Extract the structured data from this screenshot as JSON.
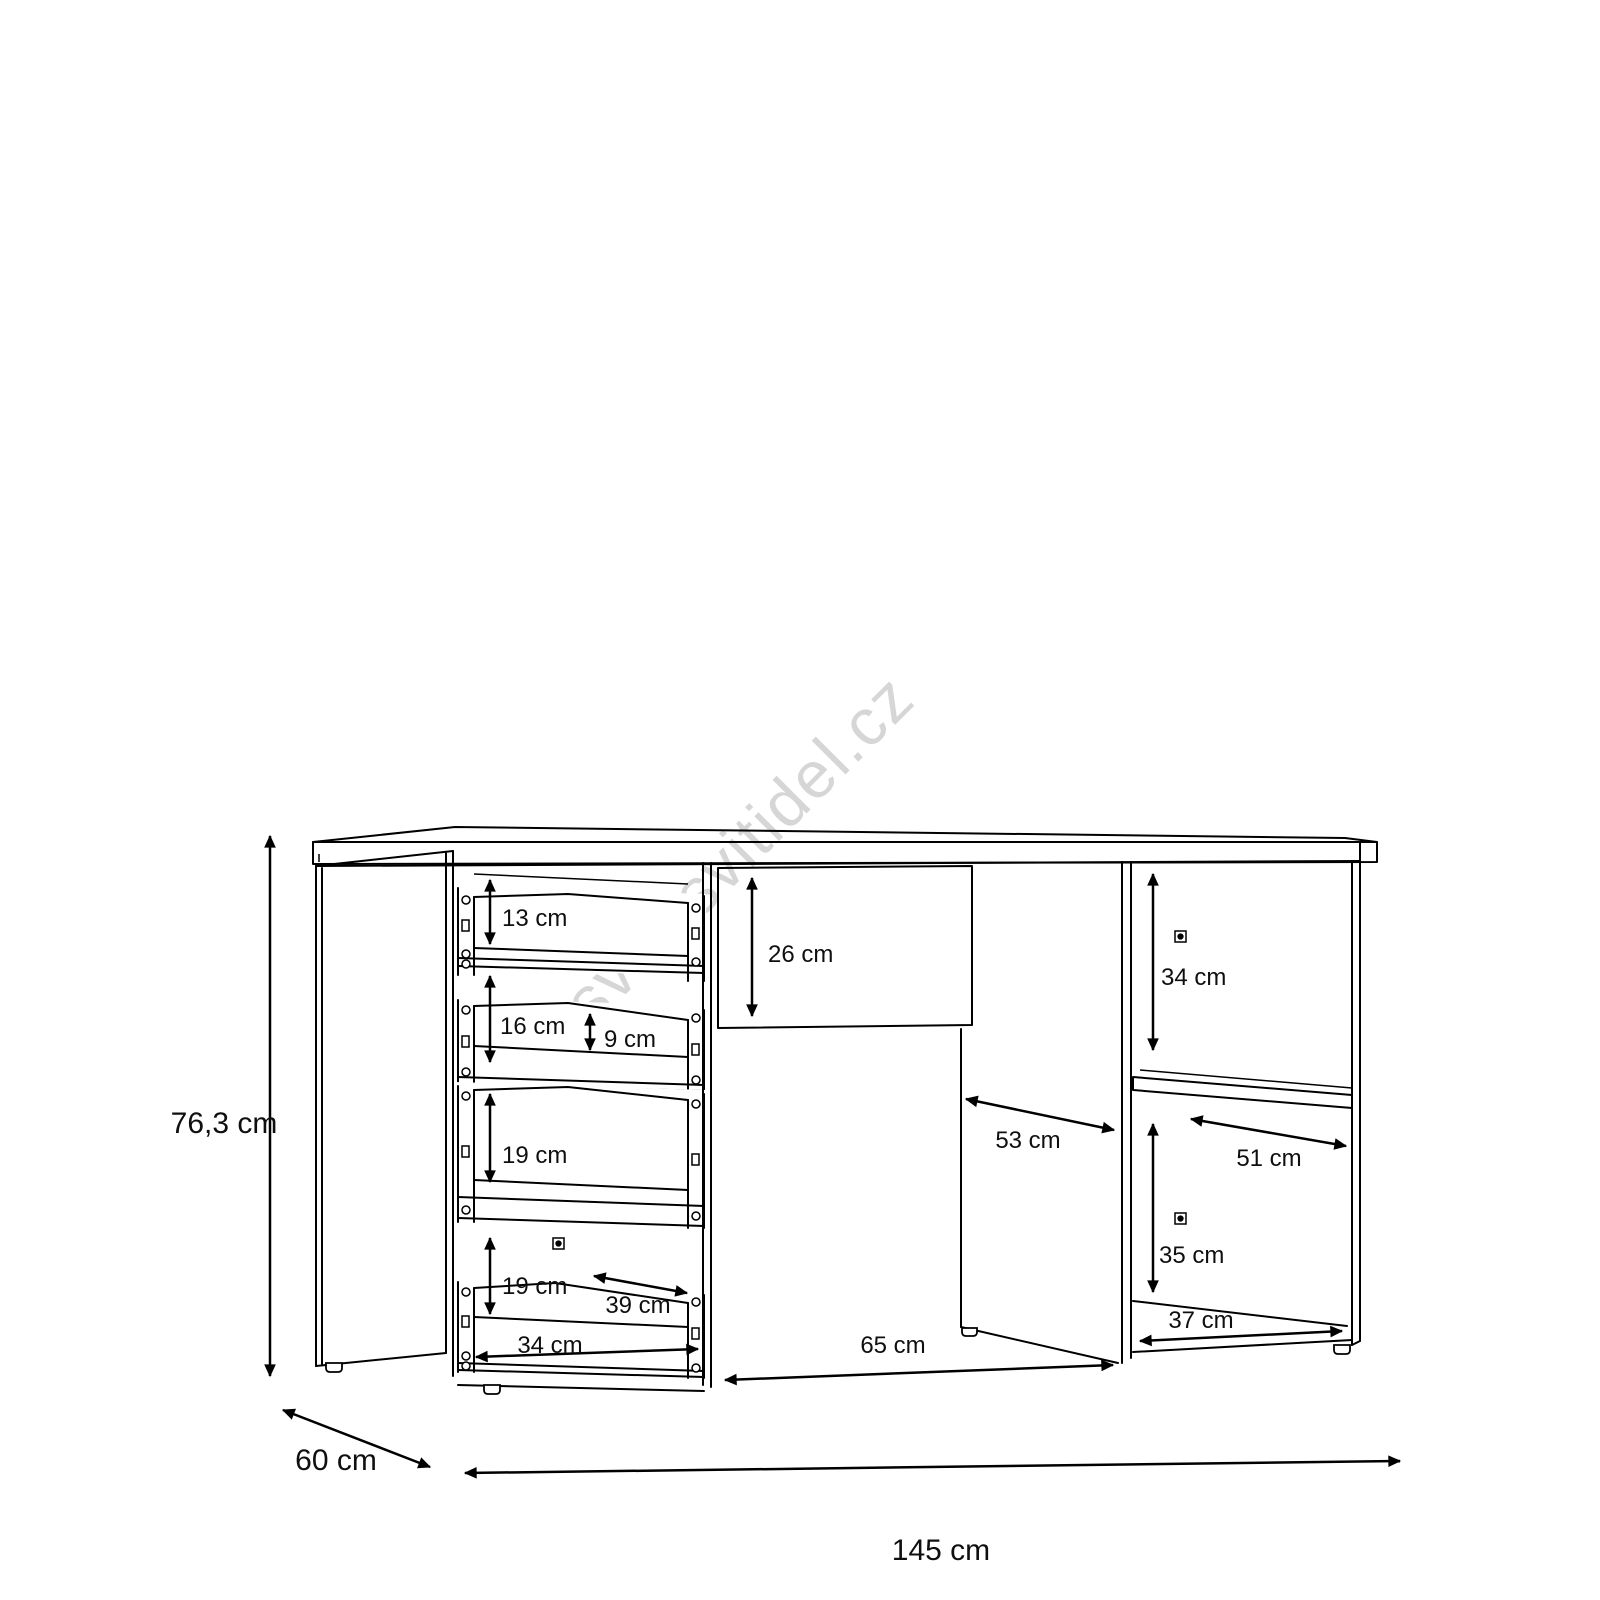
{
  "watermark": "svet-svitidel.cz",
  "diagram": {
    "type": "furniture-dimension-drawing",
    "product": "sideboard with drawers, door and open shelves",
    "units": "cm",
    "overall": {
      "height": "76,3 cm",
      "depth": "60 cm",
      "width": "145 cm"
    },
    "labels": {
      "drawer1_height": "13 cm",
      "drawer2_height": "16 cm",
      "drawer2_inner_height": "9 cm",
      "drawer3_height": "19 cm",
      "drawer4_height": "19 cm",
      "drawer_depth": "39 cm",
      "drawer_width": "34 cm",
      "top_drawer_height": "26 cm",
      "door_compartment_width": "53 cm",
      "middle_section_width": "65 cm",
      "right_top_compartment_height": "34 cm",
      "right_shelf_width": "51 cm",
      "right_bottom_compartment_height": "35 cm",
      "right_floor_depth": "37 cm"
    }
  }
}
